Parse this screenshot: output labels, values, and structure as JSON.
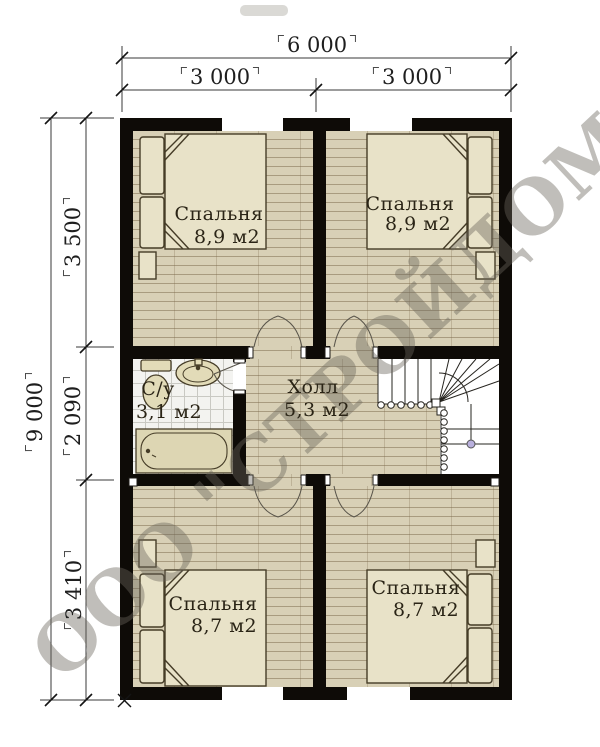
{
  "watermark": "ООО \"СТРОЙДОМ\"",
  "dimensions": {
    "top_total": "6 000",
    "top_left": "3 000",
    "top_right": "3 000",
    "left_total": "9 000",
    "left_top": "3 500",
    "left_mid": "2 090",
    "left_bottom": "3 410"
  },
  "rooms": [
    {
      "name": "Спальня",
      "area": "8,9 м2"
    },
    {
      "name": "Спальня",
      "area": "8,9 м2"
    },
    {
      "name": "С/у",
      "area": "3,1 м2"
    },
    {
      "name": "Холл",
      "area": "5,3 м2"
    },
    {
      "name": "Спальня",
      "area": "8,7 м2"
    },
    {
      "name": "Спальня",
      "area": "8,7 м2"
    }
  ]
}
